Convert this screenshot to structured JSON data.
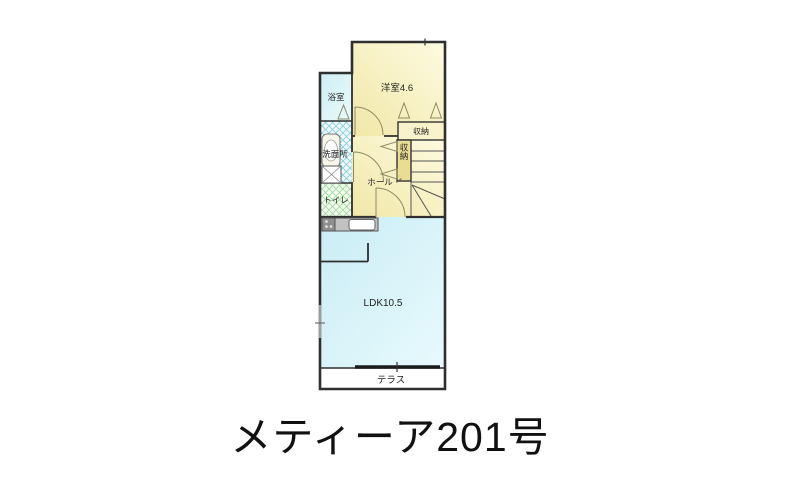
{
  "title": "メティーア201号",
  "floorplan": {
    "rooms": {
      "western_room": {
        "label": "洋室4.6"
      },
      "bathroom": {
        "label": "浴室"
      },
      "washroom": {
        "label": "洗面所"
      },
      "toilet": {
        "label": "トイレ"
      },
      "hall": {
        "label": "ホール"
      },
      "closet_upper": {
        "label": "収納"
      },
      "closet_side": {
        "label": "収納"
      },
      "ldk": {
        "label": "LDK10.5"
      },
      "terrace": {
        "label": "テラス"
      }
    },
    "colors": {
      "wall": "#2f2f2f",
      "room_cream": "#f1e7a6",
      "room_cream_light": "#fdfbe2",
      "bath_cyan": "#cceef4",
      "ldk_cyan": "#c9edf5",
      "hatch_blue": "#8fd2e2",
      "hatch_green": "#a6dda2",
      "closet_gold": "#eadc92",
      "counter_gray": "#c2c2c2",
      "stove_gray": "#8f8f8f",
      "door_line": "#8b8b66",
      "text": "#1f1f1f"
    }
  }
}
